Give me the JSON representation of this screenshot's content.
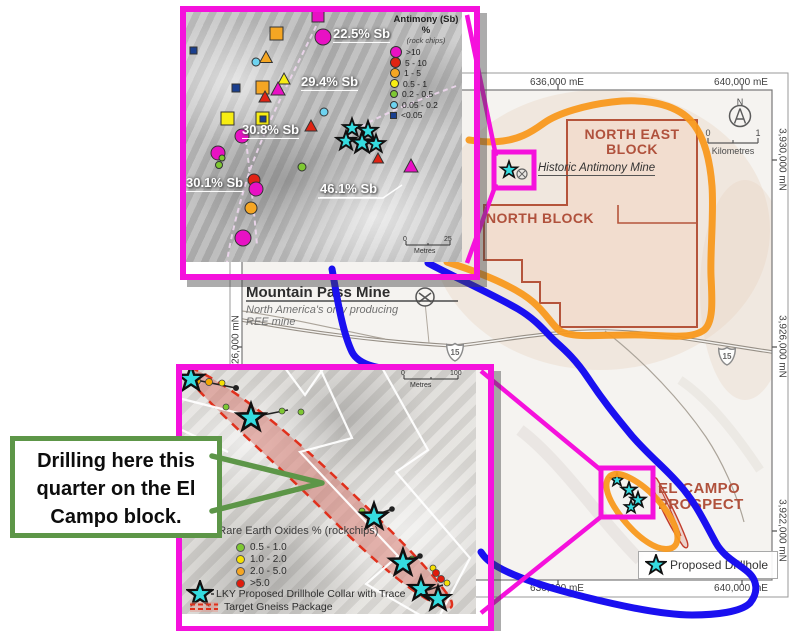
{
  "colors": {
    "highlight_magenta": "#f511dc",
    "highlight_orange": "#f8991d",
    "highlight_blue": "#1a10f0",
    "star_cyan": "#35dce0",
    "callout_green": "#5d9648",
    "block_outline": "#b5543b",
    "block_label": "#b0513c",
    "gneiss_red": "#e0301c"
  },
  "main_map": {
    "grid_labels": {
      "top_left": "636,000 mE",
      "top_right": "640,000 mE",
      "bottom_left": "636,000 mE",
      "bottom_right": "640,000 mE",
      "right_top": "3,930,000 mN",
      "right_mid": "3,926,000 mN",
      "right_bottom": "3,922,000 mN",
      "left_mid": "3,926,000 mN"
    },
    "blocks": {
      "north_east_line1": "NORTH EAST",
      "north_east_line2": "BLOCK",
      "north": "NORTH BLOCK",
      "el_campo_line1": "EL CAMPO",
      "el_campo_line2": "PROSPECT"
    },
    "historic_mine_label": "Historic Antimony Mine",
    "mountain_pass": {
      "title": "Mountain Pass Mine",
      "subtitle_line1": "North America's only producing",
      "subtitle_line2": "REE mine"
    },
    "compass": {
      "north": "N"
    },
    "scale_bar": {
      "start": "0",
      "end": "1",
      "unit": "Kilometres"
    },
    "highway_shield": "15",
    "legend": {
      "proposed_drillhole": "Proposed Drillhole"
    }
  },
  "antimony_inset": {
    "legend": {
      "title": "Antimony (Sb) %",
      "subtitle": "(rock chips)",
      "items": [
        {
          "label": ">10",
          "color": "#e811c4"
        },
        {
          "label": "5 - 10",
          "color": "#e02313"
        },
        {
          "label": "1 - 5",
          "color": "#f5a623"
        },
        {
          "label": "0.5 - 1",
          "color": "#f7ed13"
        },
        {
          "label": "0.2 - 0.5",
          "color": "#7ec832"
        },
        {
          "label": "0.05 - 0.2",
          "color": "#6ed3f0"
        },
        {
          "label": "<0.05",
          "color": "#1a3f8f"
        }
      ]
    },
    "sample_labels": [
      "22.5% Sb",
      "29.4% Sb",
      "30.8% Sb",
      "30.1% Sb",
      "46.1% Sb"
    ],
    "scale_bar": {
      "start": "0",
      "end": "25",
      "unit": "Metres"
    }
  },
  "reo_inset": {
    "legend_title": "Total Rare Earth Oxides % (rockchips)",
    "legend_items": [
      {
        "label": "0.5 - 1.0",
        "color": "#7ec832"
      },
      {
        "label": "1.0 - 2.0",
        "color": "#f5e003"
      },
      {
        "label": "2.0 - 5.0",
        "color": "#f5a623"
      },
      {
        "label": ">5.0",
        "color": "#e01b0c"
      }
    ],
    "drillhole_label": "LKY Proposed Drillhole Collar with Trace",
    "gneiss_label": "Target Gneiss Package",
    "scale_bar": {
      "start": "0",
      "end": "100",
      "unit": "Metres"
    }
  },
  "callout": {
    "line1": "Drilling here this",
    "line2": "quarter on the El",
    "line3": "Campo block."
  }
}
